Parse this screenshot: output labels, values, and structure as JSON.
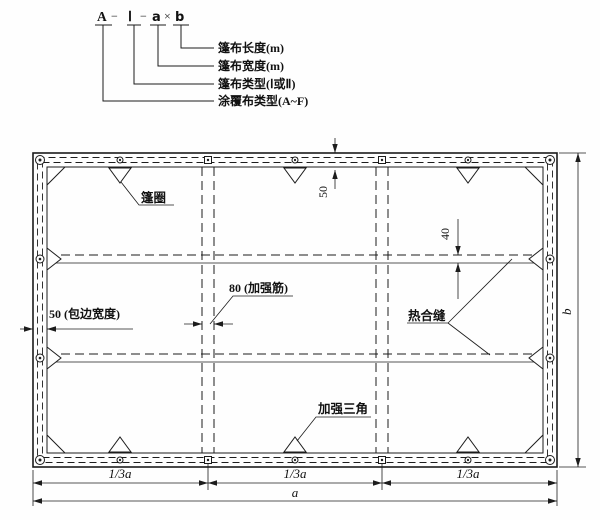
{
  "designation": {
    "code": {
      "coated_type": "A",
      "sep1": "−",
      "tarp_type": "Ⅰ",
      "sep2": "−",
      "width_var": "a",
      "times": "×",
      "length_var": "b"
    },
    "callouts": [
      {
        "label": "篷布长度(m)"
      },
      {
        "label": "篷布宽度(m)"
      },
      {
        "label": "篷布类型(Ⅰ或Ⅱ)"
      },
      {
        "label": "涂覆布类型(A~F)"
      }
    ]
  },
  "plan": {
    "grommet_label": "篷圈",
    "heat_seam_label": "热合缝",
    "triangle_label": "加强三角",
    "rib_dim": "80 (加强筋)",
    "hem_dim": "50 (包边宽度)",
    "top_hem_dim": "50",
    "seam_width_dim": "40",
    "dim_third": "1/3a",
    "dim_width": "a",
    "dim_height": "b"
  }
}
